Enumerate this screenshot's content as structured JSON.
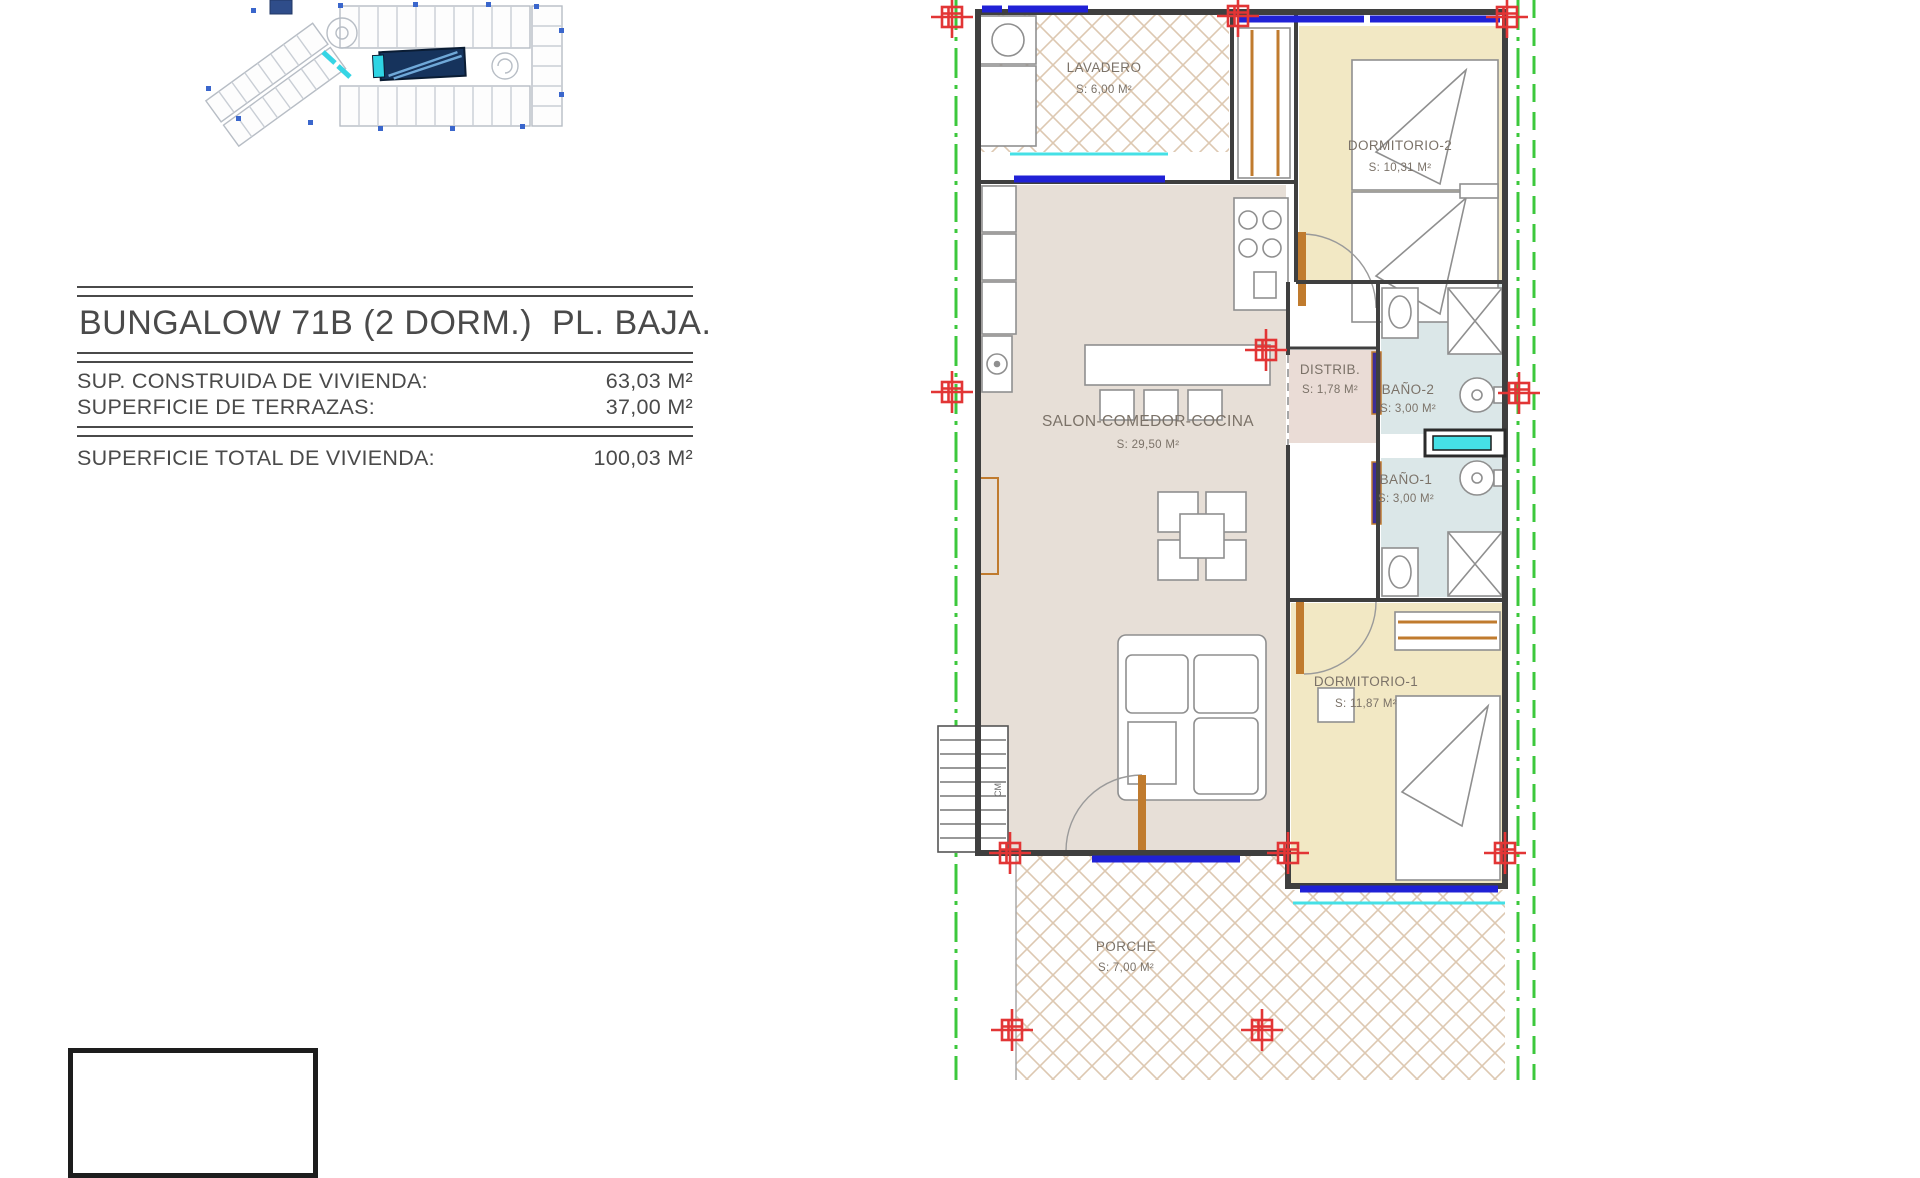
{
  "title_block": {
    "title": "BUNGALOW 71B (2 DORM.)  PL. BAJA.",
    "rows": [
      {
        "label": "SUP. CONSTRUIDA DE VIVIENDA:",
        "value": "63,03 M²"
      },
      {
        "label": "SUPERFICIE DE TERRAZAS:",
        "value": "37,00 M²"
      },
      {
        "label": "SUPERFICIE TOTAL DE VIVIENDA:",
        "value": "100,03 M²"
      }
    ]
  },
  "floor_plan": {
    "rooms": [
      {
        "id": "lavadero",
        "name": "LAVADERO",
        "area": "S: 6,00 M²",
        "fill": "hatch"
      },
      {
        "id": "dormitorio-2",
        "name": "DORMITORIO-2",
        "area": "S: 10,31 M²",
        "fill": "#f2e8c4"
      },
      {
        "id": "salon",
        "name": "SALON-COMEDOR-COCINA",
        "area": "S: 29,50 M²",
        "fill": "#e7dfd7"
      },
      {
        "id": "distribuidor",
        "name": "DISTRIB.",
        "area": "S: 1,78 M²",
        "fill": "#eadcd6"
      },
      {
        "id": "bano-2",
        "name": "BAÑO-2",
        "area": "S: 3,00 M²",
        "fill": "#dbe7e8"
      },
      {
        "id": "bano-1",
        "name": "BAÑO-1",
        "area": "S: 3,00 M²",
        "fill": "#dbe7e8"
      },
      {
        "id": "dormitorio-1",
        "name": "DORMITORIO-1",
        "area": "S: 11,87 M²",
        "fill": "#f2e8c4"
      },
      {
        "id": "porche",
        "name": "PORCHE",
        "area": "S: 7,00 M²",
        "fill": "hatch"
      }
    ],
    "stair_label": "CM",
    "colors": {
      "boundary_green": "#3cc83c",
      "marker_red": "#e23535",
      "window_blue": "#2021d6",
      "glass_cyan": "#45e0e6",
      "wall_gray": "#3f3f3f",
      "wood_orange": "#c07b2e",
      "door_indigo": "#3d2e96"
    }
  },
  "site_plan": {
    "colors": {
      "outline": "#b7bdc5",
      "pool_navy": "#16335c",
      "accent_cyan": "#2fd4e4",
      "dot_blue": "#3a66cc"
    }
  }
}
